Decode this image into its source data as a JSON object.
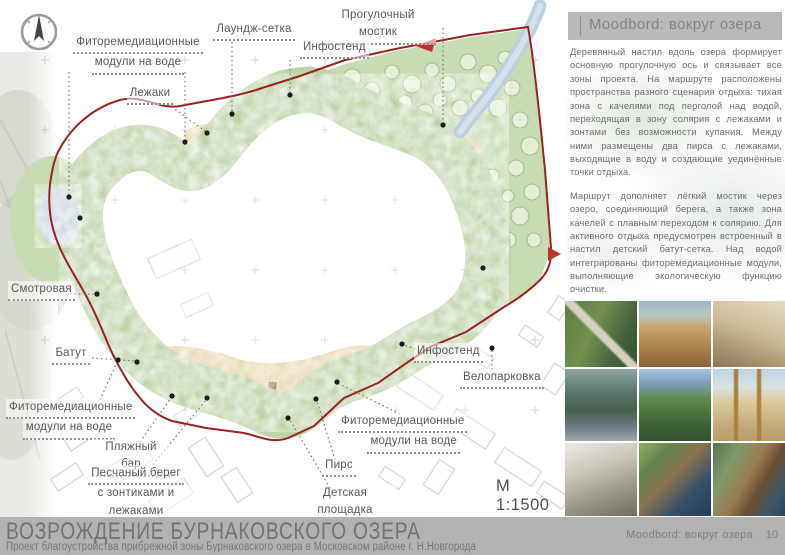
{
  "sheet": {
    "title": "ВОЗРОЖДЕНИЕ БУРНАКОВСКОГО ОЗЕРА",
    "subtitle": "Проект благоустройства прибрежной зоны Бурнаковского озера в Московском районе г. Н.Новгорода",
    "footer_caption": "Moodbord: вокруг озера",
    "page_number": "10"
  },
  "plan": {
    "scale_label": "М 1:1500",
    "lake_watermark": "озеро Бурнаковское нижнее",
    "labels": {
      "fito_top": {
        "line1": "Фиторемедиационные",
        "line2": "модули на воде"
      },
      "lezhaki": {
        "line1": "Лежаки"
      },
      "lounge_net": {
        "line1": "Лаундж-сетка"
      },
      "bridge": {
        "line1": "Прогулочный мостик"
      },
      "info_top": {
        "line1": "Инфостенд"
      },
      "smotrovaya": {
        "line1": "Смотровая"
      },
      "batut": {
        "line1": "Батут"
      },
      "fito_bl": {
        "line1": "Фиторемедиационные",
        "line2": "модули на воде"
      },
      "beach_bar": {
        "line1": "Пляжный бар"
      },
      "sand_shore": {
        "line1": "Песчаный берег",
        "line2": "с зонтиками и лежаками"
      },
      "pier": {
        "line1": "Пирс"
      },
      "kids": {
        "line1": "Детская площадка"
      },
      "fito_br": {
        "line1": "Фиторемедиационные",
        "line2": "модули на воде"
      },
      "info_right": {
        "line1": "Инфостенд"
      },
      "bike": {
        "line1": "Велопарковка"
      }
    }
  },
  "panel": {
    "header": "Moodbord: вокруг озера",
    "paragraphs": {
      "p1": "Деревянный настил вдоль озера формирует основную прогулочную ось и связывает все зоны проекта. На маршруте расположены пространства разного сценария отдыха: тихая зона с качелями под перголой над водой, переходящая в зону солярия с лежаками и зонтами без возможности купания. Между ними размещены два пирса с лежаками, выходящие в воду и создающие уединённые точки отдыха.",
      "p2": "Маршрут дополняет лёгкий мостик через озеро, соединяющий берега, а также зона качелей с плавным переходом к солярию. Для активного отдыха предусмотрен встроенный в настил детский батут-сетка. Над водой интегрированы фиторемедиационные модули, выполняющие экологическую функцию очистки.",
      "p3": "На входе расположена велопарковка, а в зоне отдыха — лаундж-сетка, создающая эффект «парения» над ландшафтом и усиливающая ощущение единения с природой."
    },
    "photos": [
      "Зигзагообразный настил среди прибрежной зелени",
      "Песчаный пляж с соломенными зонтами и лежаками",
      "Деревянный настил-солярий с отдыхающими",
      "Деревянные пирсы-платформы на озере",
      "Парковая дорожка со скамьёй у пруда",
      "Деревянная детская площадка на песке",
      "Навес велопарковки с велосипедом",
      "Лаундж-сетка над водой у настила",
      "Изогнутый деревянный настил вдоль берега"
    ]
  },
  "icons": {
    "compass": "compass-north-arrow-icon"
  },
  "colors": {
    "water": "#cdd9e2",
    "greenery": "#c7dcb2",
    "boardwalk_brown": "#8b7257",
    "sand": "#e9d8b2",
    "boundary_red": "#992323",
    "footer_gray": "#b2b2b2",
    "label_gray": "#585858"
  }
}
